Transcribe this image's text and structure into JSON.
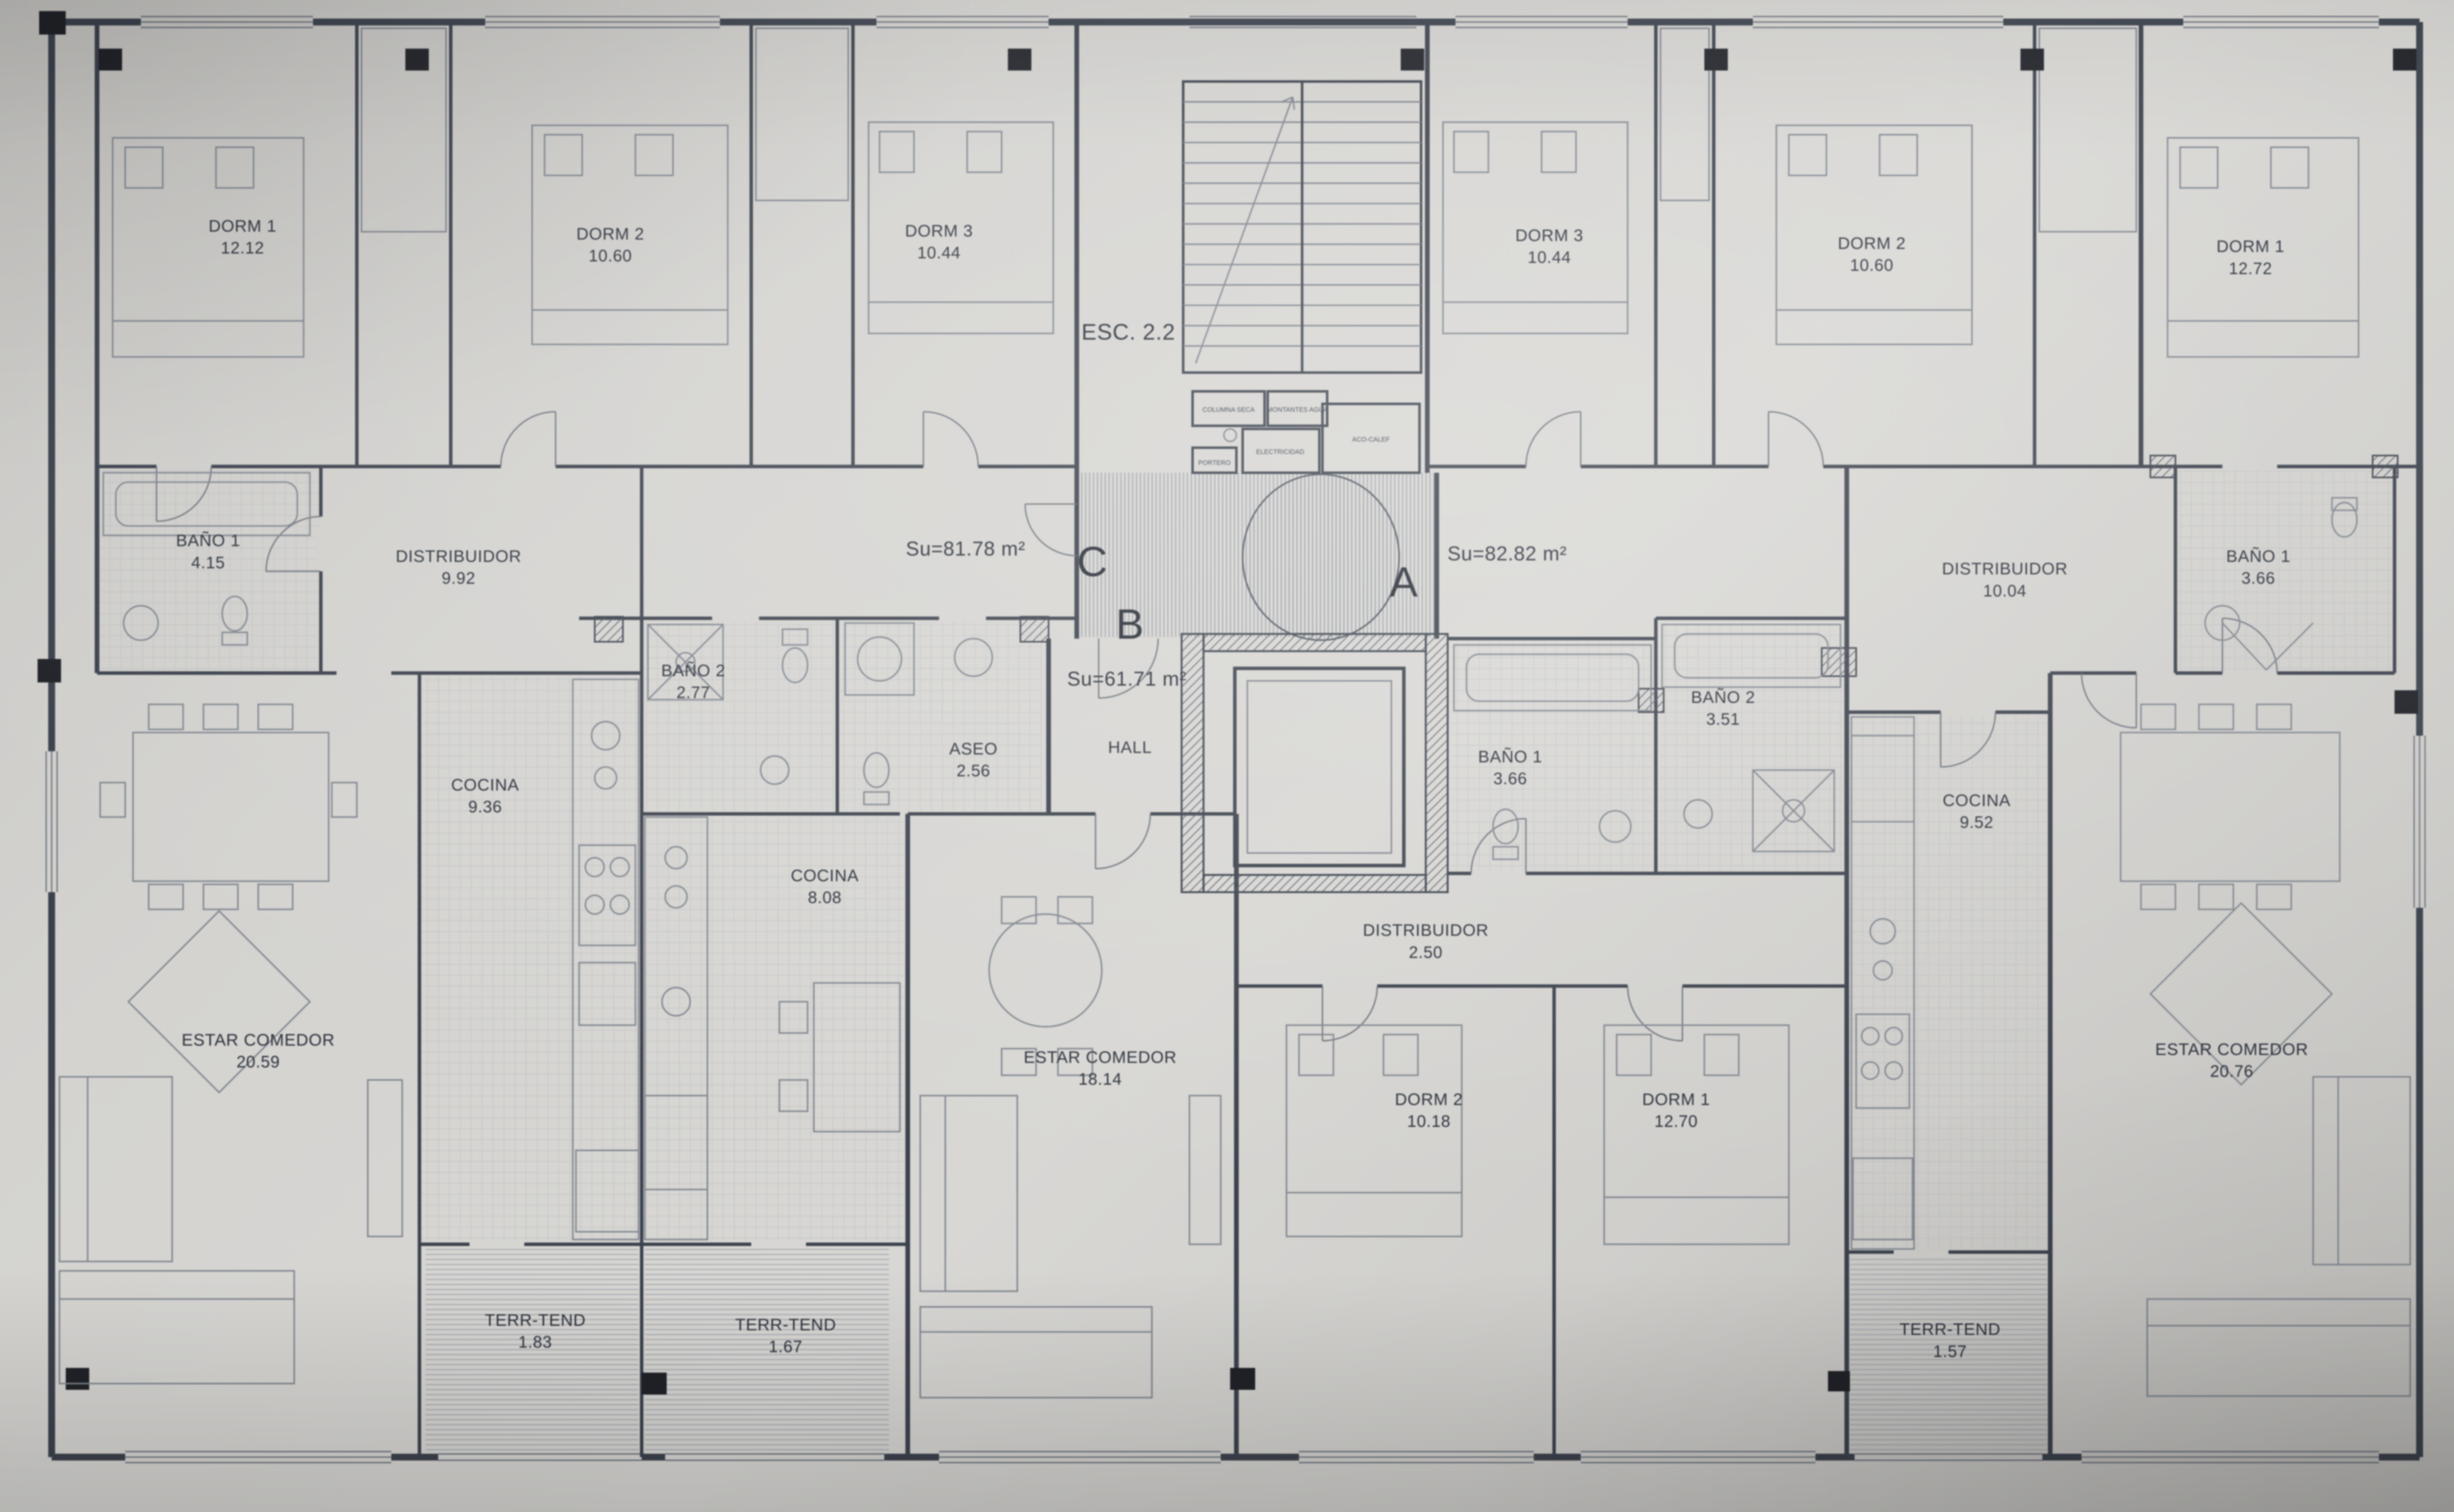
{
  "stair": {
    "label": "ESC. 2.2"
  },
  "apartments": [
    {
      "letter": "C",
      "su": "Su=81.78 m²"
    },
    {
      "letter": "B",
      "su": "Su=61.71 m²"
    },
    {
      "letter": "A",
      "su": "Su=82.82 m²"
    }
  ],
  "rooms": {
    "dorm1_l": {
      "name": "DORM 1",
      "area": "12.12"
    },
    "dorm2_l": {
      "name": "DORM 2",
      "area": "10.60"
    },
    "dorm3_l": {
      "name": "DORM 3",
      "area": "10.44"
    },
    "dorm3_r": {
      "name": "DORM 3",
      "area": "10.44"
    },
    "dorm2_r": {
      "name": "DORM 2",
      "area": "10.60"
    },
    "dorm1_r": {
      "name": "DORM 1",
      "area": "12.72"
    },
    "bano1_l": {
      "name": "BAÑO 1",
      "area": "4.15"
    },
    "distribuidor_l": {
      "name": "DISTRIBUIDOR",
      "area": "9.92"
    },
    "distribuidor_r": {
      "name": "DISTRIBUIDOR",
      "area": "10.04"
    },
    "bano1_r": {
      "name": "BAÑO 1",
      "area": "3.66"
    },
    "bano2_c": {
      "name": "BAÑO 2",
      "area": "2.77"
    },
    "aseo": {
      "name": "ASEO",
      "area": "2.56"
    },
    "hall": {
      "name": "HALL"
    },
    "bano1_c": {
      "name": "BAÑO 1",
      "area": "3.66"
    },
    "bano2_r": {
      "name": "BAÑO 2",
      "area": "3.51"
    },
    "cocina_l": {
      "name": "COCINA",
      "area": "9.36"
    },
    "cocina_c": {
      "name": "COCINA",
      "area": "8.08"
    },
    "cocina_r": {
      "name": "COCINA",
      "area": "9.52"
    },
    "distribuidor_c": {
      "name": "DISTRIBUIDOR",
      "area": "2.50"
    },
    "estar_l": {
      "name": "ESTAR COMEDOR",
      "area": "20.59"
    },
    "estar_c": {
      "name": "ESTAR COMEDOR",
      "area": "18.14"
    },
    "estar_r": {
      "name": "ESTAR COMEDOR",
      "area": "20.76"
    },
    "dorm2_b": {
      "name": "DORM 2",
      "area": "10.18"
    },
    "dorm1_b": {
      "name": "DORM 1",
      "area": "12.70"
    },
    "terr1": {
      "name": "TERR-TEND",
      "area": "1.83"
    },
    "terr2": {
      "name": "TERR-TEND",
      "area": "1.67"
    },
    "terr3": {
      "name": "TERR-TEND",
      "area": "1.57"
    }
  },
  "utility": {
    "columna_seca": "COLUMNA SECA",
    "montantes": "MONTANTES AGUA",
    "aco_calef": "ACO-CALEF",
    "electricidad": "ELECTRICIDAD",
    "portero": "PORTERO"
  },
  "colors": {
    "paper": "#d4d3d0",
    "ink": "#3c424d",
    "text": "#2c313b",
    "hatch": "#9aa0a8",
    "column": "#202228"
  }
}
